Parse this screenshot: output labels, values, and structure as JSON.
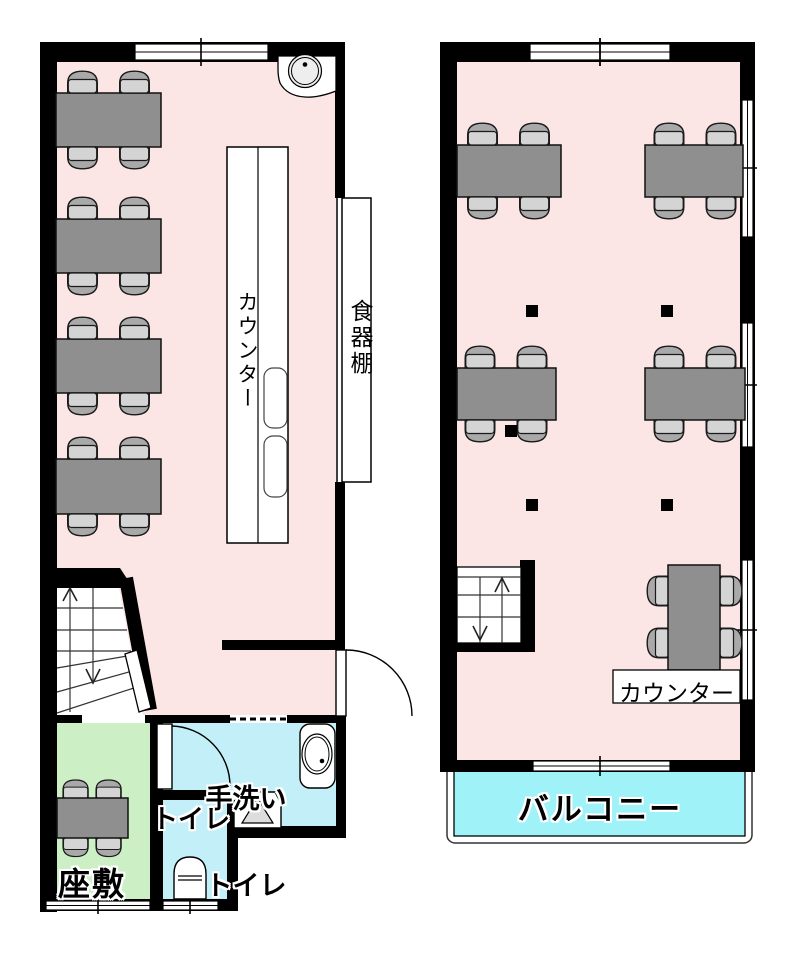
{
  "floor1": {
    "labels": {
      "counter": "カウンター",
      "cupboard": "食器棚",
      "handwash_line1": "手洗い",
      "handwash_line2": "トイレ",
      "toilet": "トイレ",
      "tatami": "座敷"
    }
  },
  "floor2": {
    "labels": {
      "counter": "カウンター",
      "balcony": "バルコニー"
    }
  },
  "colors": {
    "floor_pink": "#fbe5e5",
    "tatami_green": "#ccefc5",
    "toilet_cyan": "#c3f0f8",
    "balcony_cyan": "#9ff2f8",
    "table_gray": "#8f8f8f",
    "chair_back_gray": "#a9a9a9",
    "chair_seat_gray": "#d4d4d4",
    "wall_black": "#000000"
  }
}
